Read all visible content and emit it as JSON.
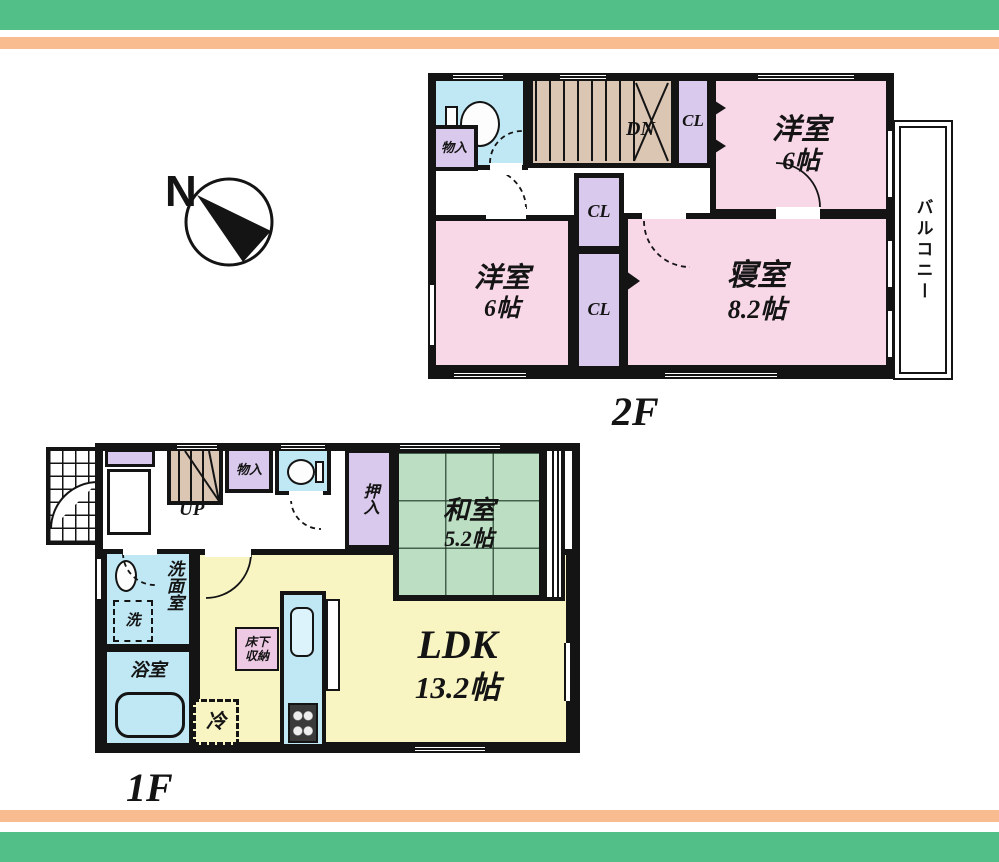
{
  "compass": {
    "north": "N"
  },
  "floor2": {
    "label": "2F",
    "stairs": "DN",
    "storage": "物入",
    "closet_top": "CL",
    "closet_mid": "CL",
    "closet_bottom": "CL",
    "balcony": "バルコニー",
    "rooms": {
      "western_room_a": {
        "name": "洋室",
        "size": "6帖"
      },
      "bedroom": {
        "name": "寝室",
        "size": "8.2帖"
      },
      "western_room_b": {
        "name": "洋室",
        "size": "6帖"
      }
    }
  },
  "floor1": {
    "label": "1F",
    "stairs": "UP",
    "storage": "物入",
    "futon_closet": "押入",
    "washroom": "洗面室",
    "washer": "洗",
    "bathroom": "浴室",
    "fridge": "冷",
    "underfloor_line1": "床下",
    "underfloor_line2": "収納",
    "rooms": {
      "japanese_room": {
        "name": "和室",
        "size": "5.2帖"
      },
      "ldk": {
        "name": "LDK",
        "size": "13.2帖"
      }
    }
  },
  "colors": {
    "wall": "#141414",
    "stripe_green": "#52bf89",
    "stripe_orange": "#f9bc90",
    "room_pink": "#f8d7e7",
    "closet_purple": "#d9c9ec",
    "water_blue": "#bfe7f4",
    "stair_tan": "#dbc6b4",
    "tatami_green": "#bcdfc3",
    "ldk_yellow": "#f8f5c3",
    "underfloor_pink": "#edc9e3"
  }
}
